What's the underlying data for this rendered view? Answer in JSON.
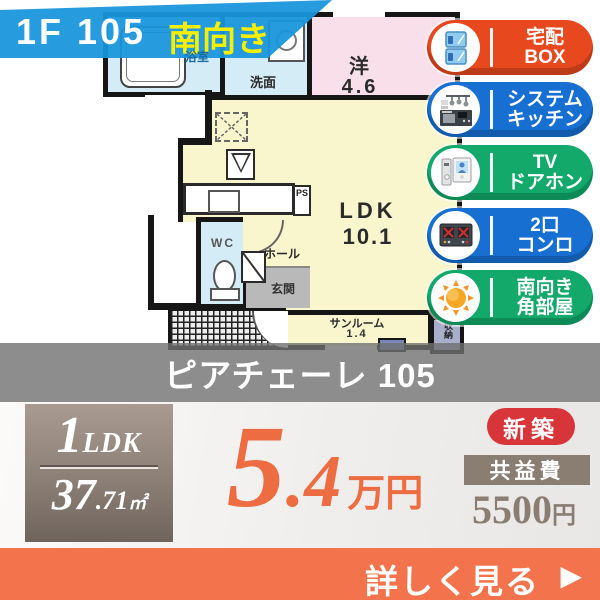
{
  "banner": {
    "unit": "1F 105",
    "direction": "南向き",
    "bg_color": "#1896dd",
    "direction_color": "#f7ef00"
  },
  "floorplan": {
    "bath_label": "浴室",
    "washroom_label": "洗面",
    "western_label": "洋",
    "western_size": "4.6",
    "ldk_label": "LDK",
    "ldk_size": "10.1",
    "wc_label": "WC",
    "hall_label": "ホール",
    "entrance_label": "玄関",
    "sunroom_label": "サンルーム",
    "sunroom_size": "1.4",
    "storage_label": "収納",
    "ps_label": "PS",
    "room_colors": {
      "ldk": "#f9f5cd",
      "western": "#f8dfe9",
      "wet": "#d4ecf6",
      "entrance": "#b9b9b9",
      "storage": "#a9aecb"
    }
  },
  "badges": [
    {
      "line1": "宅配",
      "line2": "BOX",
      "color": "#e8481e",
      "icon": "delivery-box-icon"
    },
    {
      "line1": "システム",
      "line2": "キッチン",
      "color": "#176fd2",
      "icon": "system-kitchen-icon"
    },
    {
      "line1": "TV",
      "line2": "ドアホン",
      "color": "#12a96b",
      "icon": "tv-doorphone-icon"
    },
    {
      "line1": "2口",
      "line2": "コンロ",
      "color": "#176fd2",
      "icon": "two-burner-stove-icon"
    },
    {
      "line1": "南向き",
      "line2": "角部屋",
      "color": "#12a96b",
      "icon": "sun-icon"
    }
  ],
  "property_name": "ピアチェーレ 105",
  "summary": {
    "layout_num": "1",
    "layout_type": "LDK",
    "area_int": "37",
    "area_frac": ".71",
    "area_unit": "㎡",
    "rent_int": "5",
    "rent_frac": ".4",
    "rent_unit": "万円",
    "rent_color": "#ed6c42",
    "new_label": "新築",
    "new_color": "#d8353b",
    "fee_label": "共益費",
    "fee_value": "5500",
    "fee_unit": "円",
    "fee_color": "#8a7d72"
  },
  "cta": {
    "label": "詳しく見る",
    "arrow": "▶",
    "bg_color": "#f3744c"
  }
}
